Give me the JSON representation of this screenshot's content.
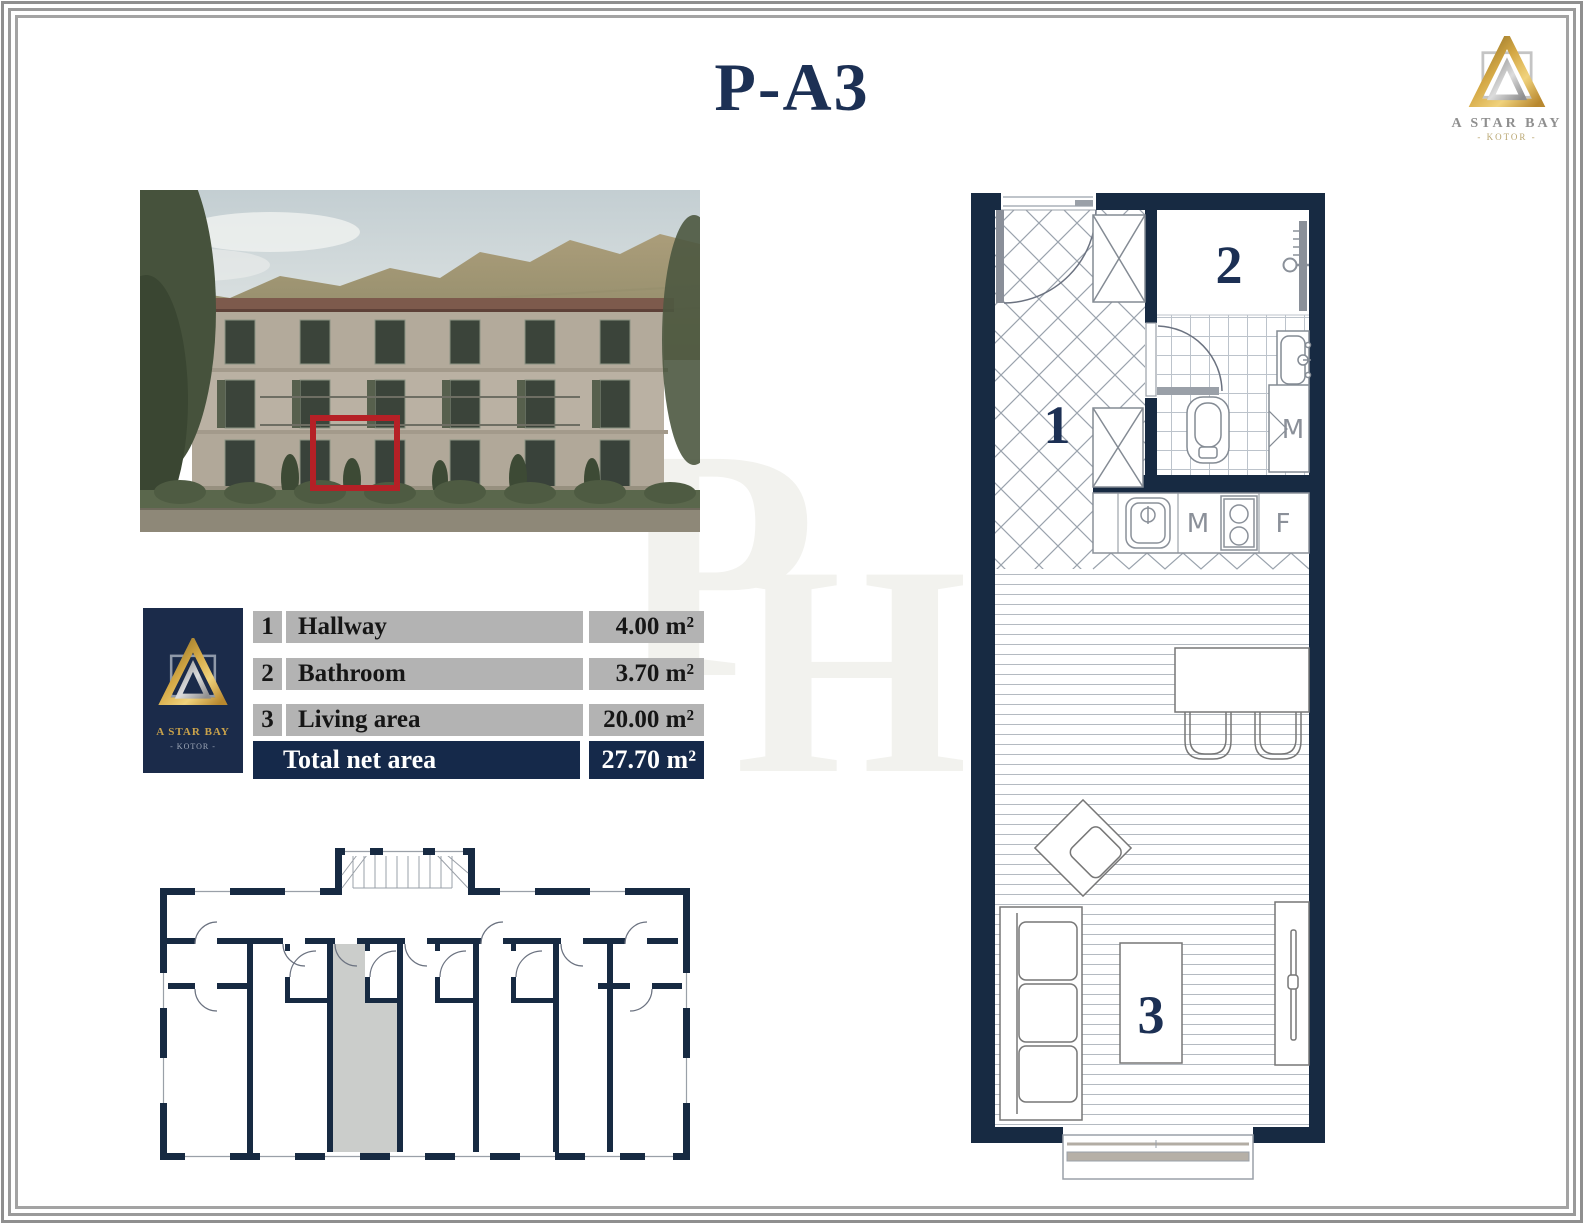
{
  "page": {
    "title": "P-A3"
  },
  "brand_top": {
    "name": "A STAR BAY",
    "subtitle": "- KOTOR -"
  },
  "area_table": {
    "logo": {
      "name": "A STAR BAY",
      "subtitle": "- KOTOR -"
    },
    "rows": [
      {
        "num": "1",
        "label": "Hallway",
        "area": "4.00 m²"
      },
      {
        "num": "2",
        "label": "Bathroom",
        "area": "3.70 m²"
      },
      {
        "num": "3",
        "label": "Living area",
        "area": "20.00 m²"
      }
    ],
    "total_label": "Total net area",
    "total_area": "27.70 m²"
  },
  "floor_plan": {
    "room_labels": {
      "hallway": "1",
      "bathroom": "2",
      "living": "3"
    },
    "appliance_labels": {
      "bathroom_washer": "M",
      "kitchen_washer": "M",
      "fridge": "F"
    }
  },
  "watermark": {
    "p": "P",
    "h": "H"
  },
  "colors": {
    "wall_navy": "#172a42",
    "title_navy": "#1c3054",
    "table_gray": "#b3b3b3",
    "total_navy": "#15294a",
    "logo_navy": "#1b2b4a",
    "gold": "#c79a3e",
    "highlight_red": "#b52026",
    "unit_highlight_gray": "#cbcdcb"
  }
}
